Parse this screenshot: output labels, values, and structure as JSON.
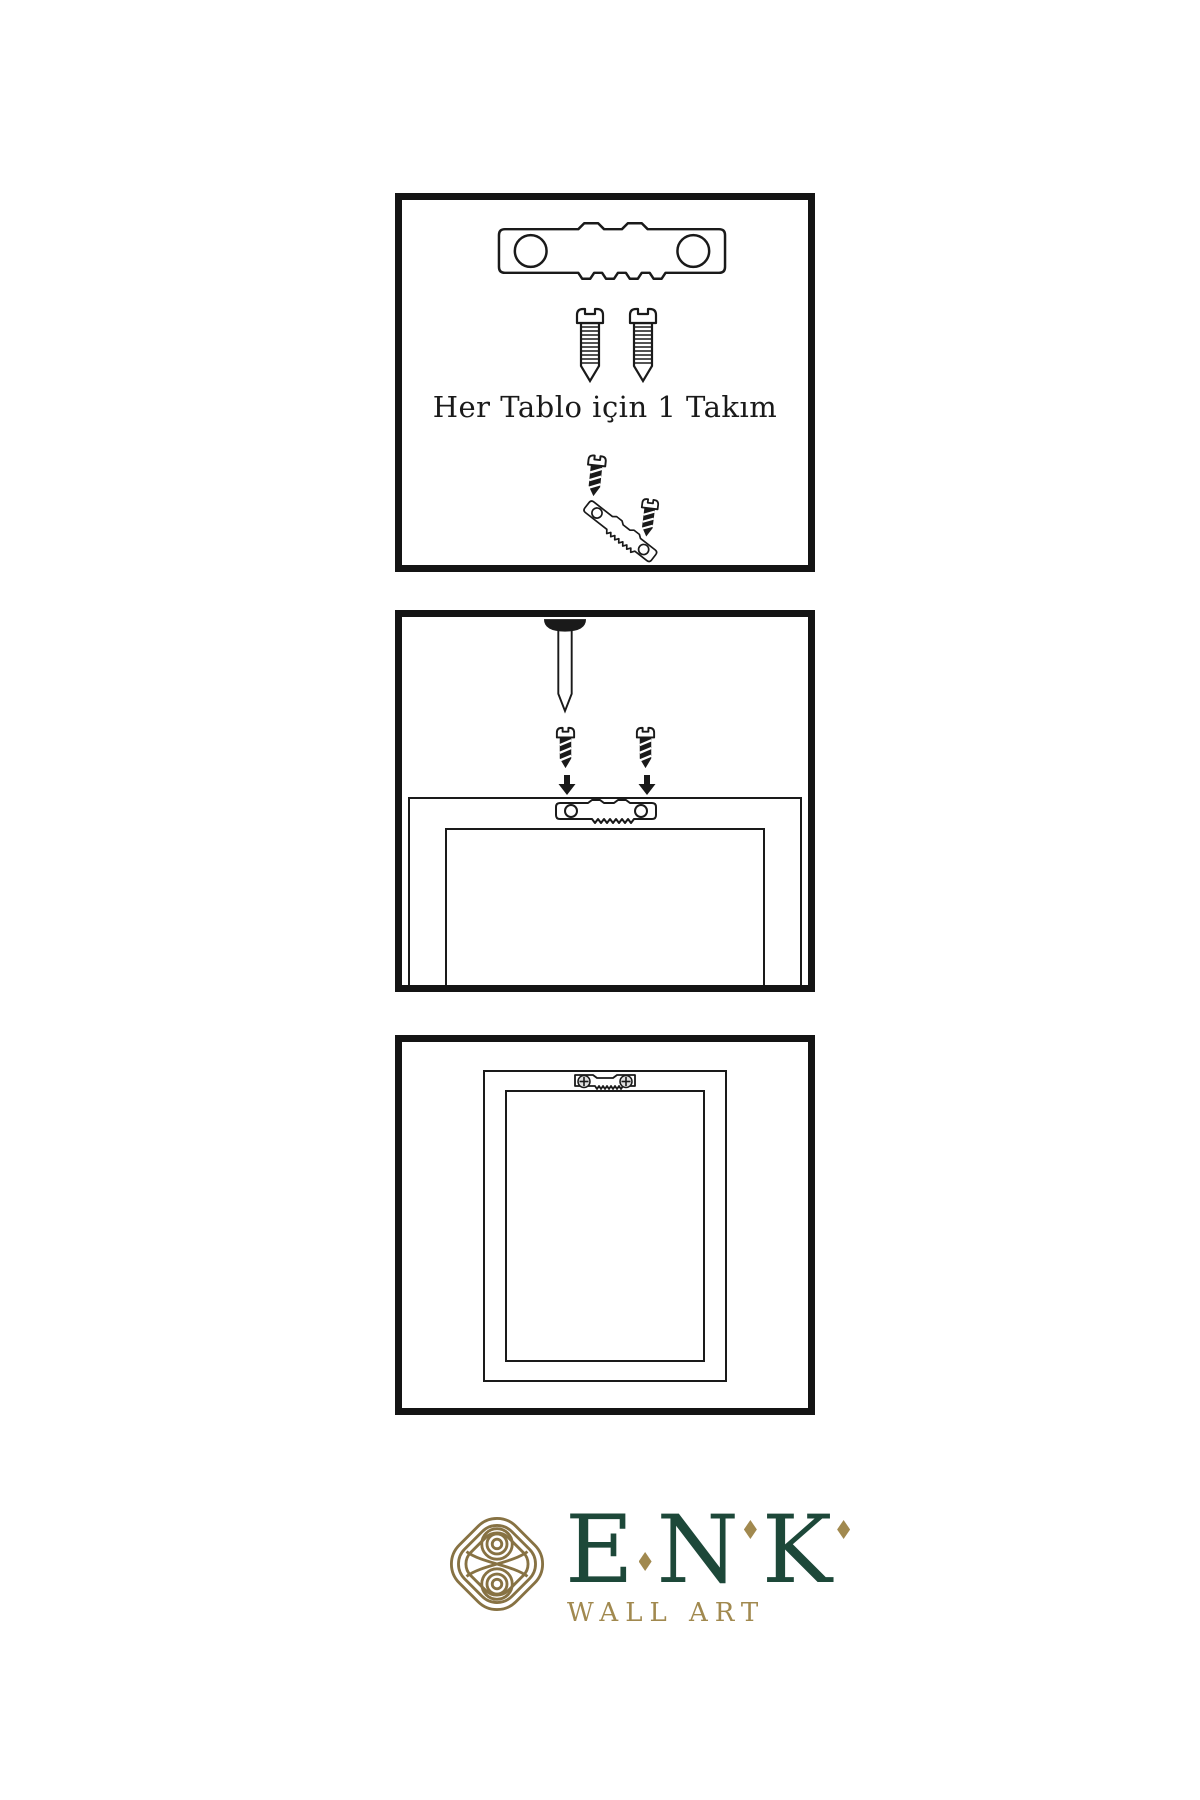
{
  "sheet": {
    "background": "#ffffff"
  },
  "colors": {
    "ink": "#1a1a1a",
    "border": "#141414",
    "green": "#1d4839",
    "gold": "#a1894f",
    "knot": "#877243",
    "metal": "#e0e0e0",
    "paper": "#ffffff"
  },
  "panels": {
    "kit": {
      "caption": "Her Tablo için 1 Takım",
      "icons": [
        "sawtooth-hanger",
        "screw",
        "screw",
        "screw",
        "sawtooth-hanger-angled",
        "screw"
      ]
    },
    "install": {
      "icons": [
        "wall-nail",
        "screw",
        "screw",
        "down-arrow",
        "down-arrow",
        "sawtooth-hanger",
        "picture-frame-back"
      ]
    },
    "hang": {
      "icons": [
        "picture-frame-back",
        "sawtooth-hanger-mounted"
      ]
    }
  },
  "logo": {
    "letters": [
      "E",
      "N",
      "K"
    ],
    "subtitle": "WALL ART"
  }
}
